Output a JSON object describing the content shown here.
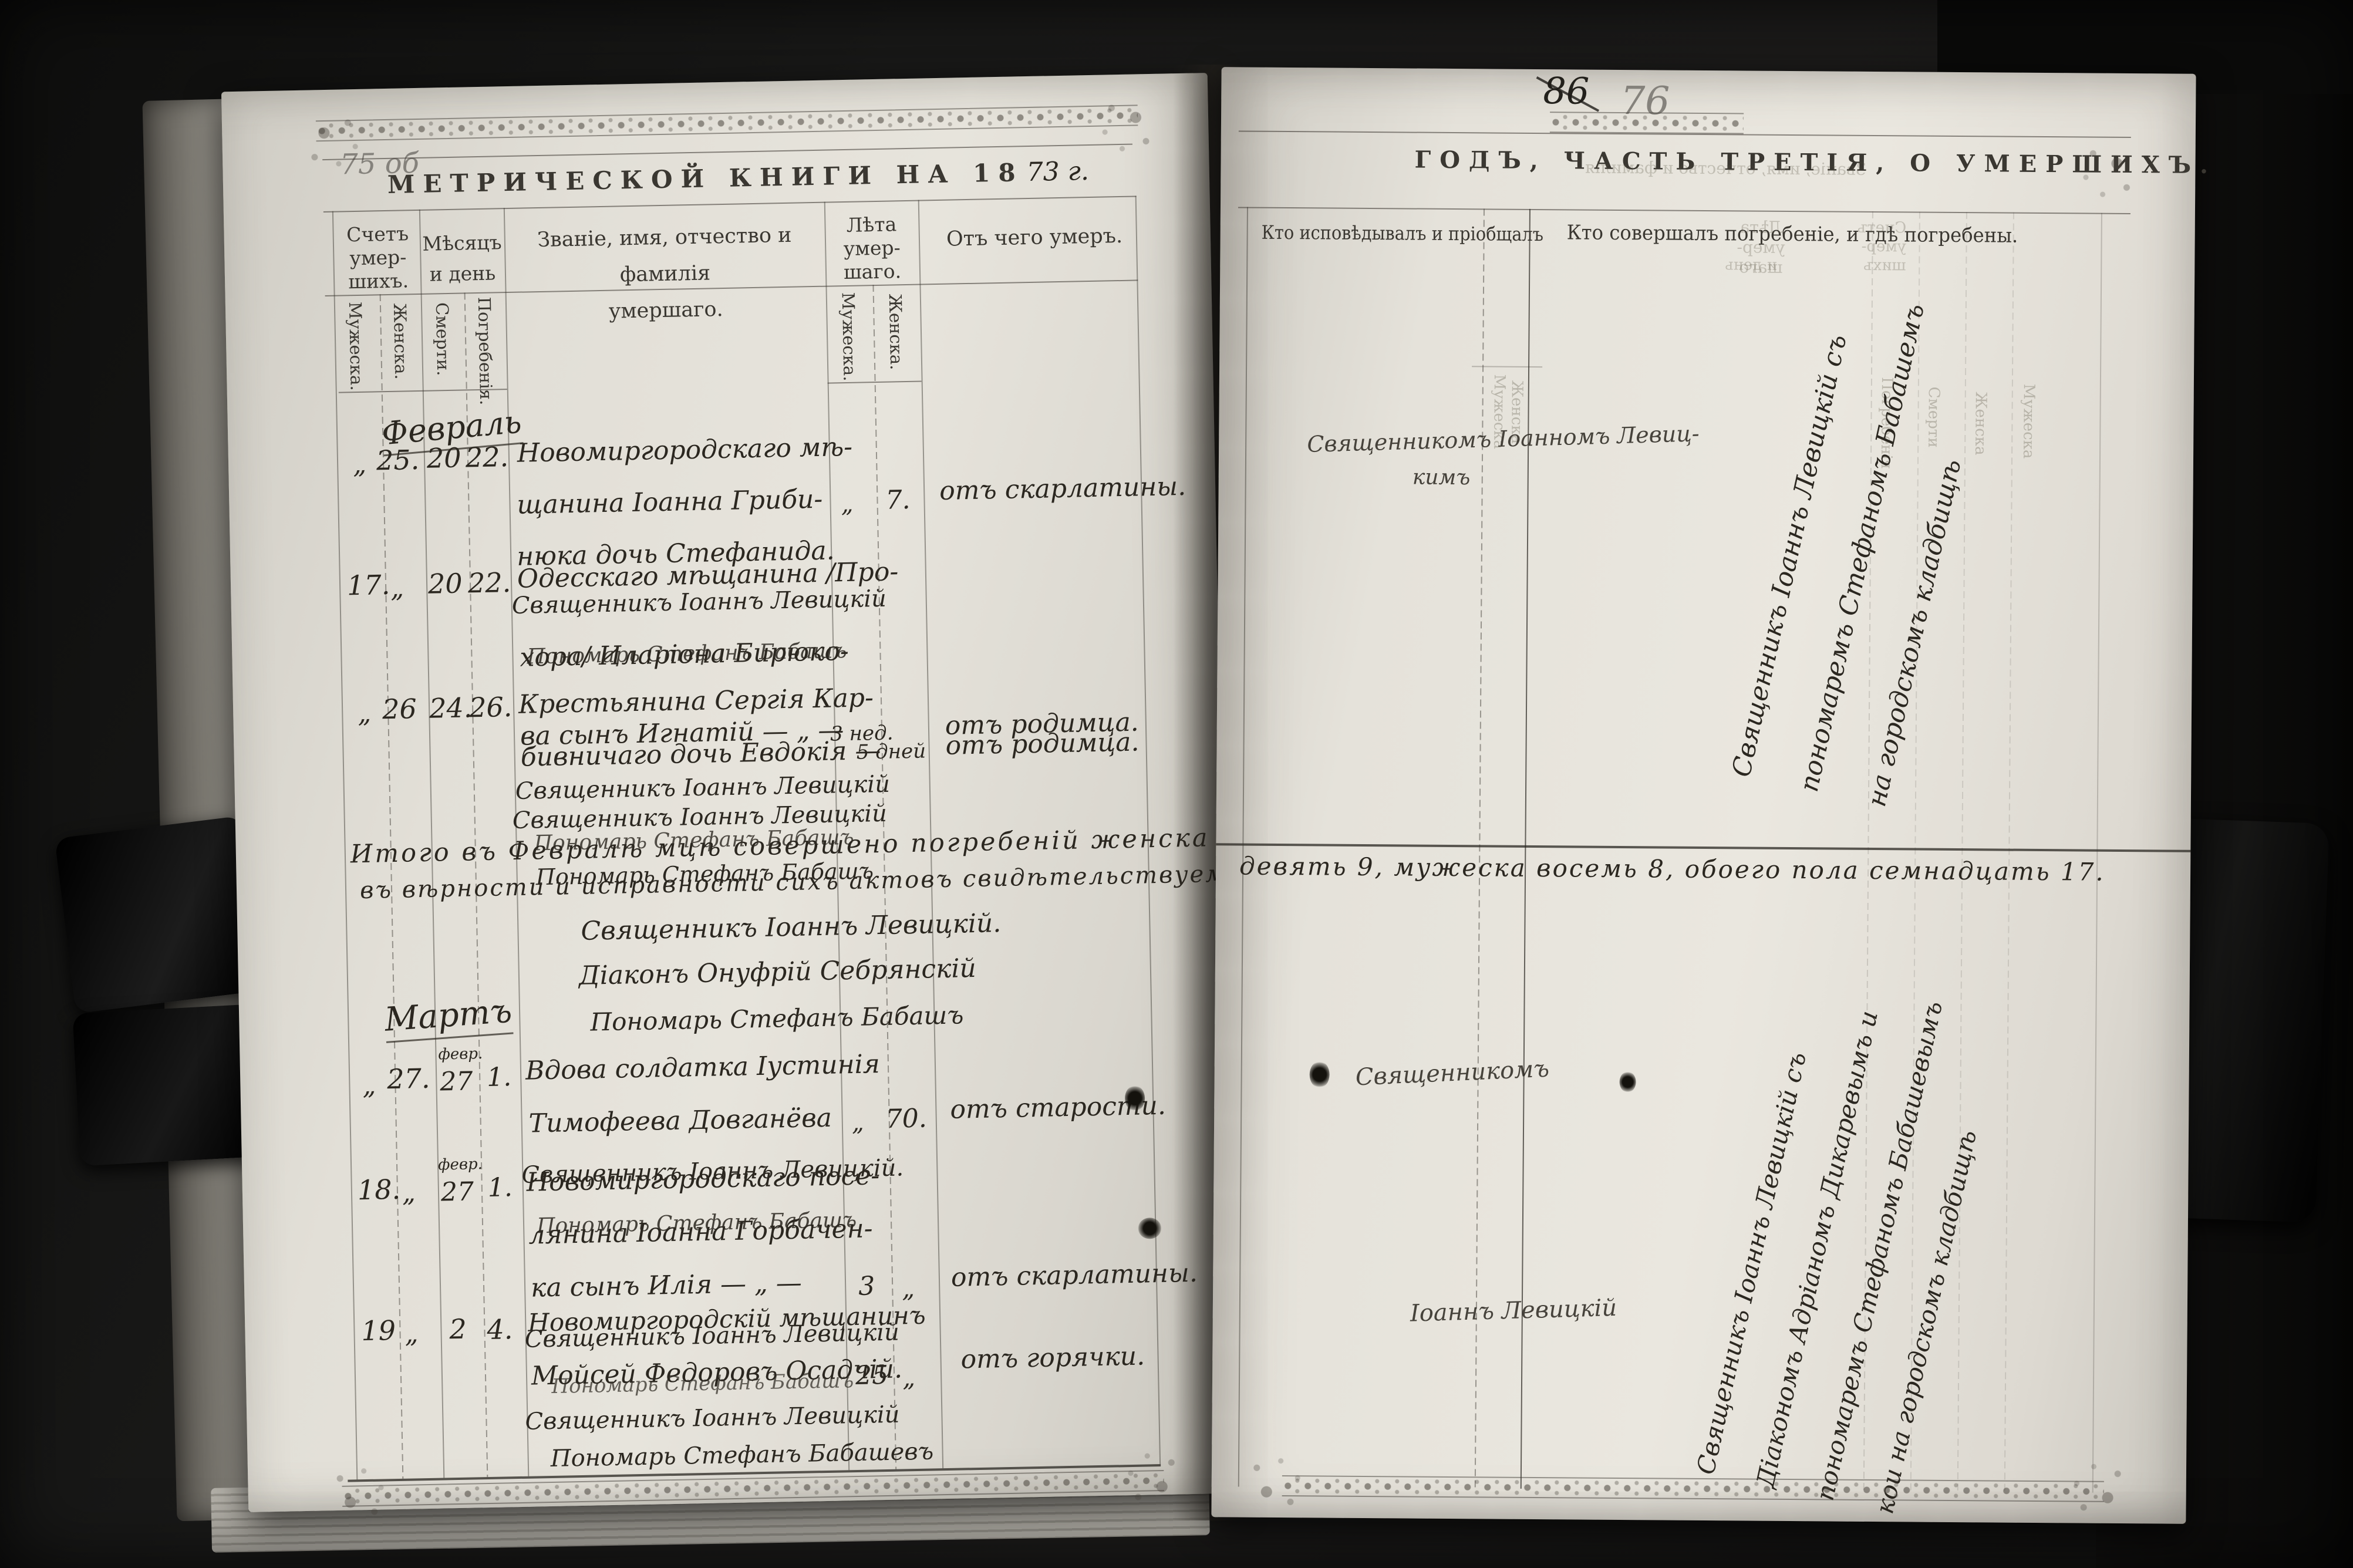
{
  "scene": {
    "background": "#141413",
    "page_color": "#e0ddd5",
    "ink": "#2b2720",
    "pencil": "#85827c",
    "objects": [
      "book-left-page",
      "book-right-page",
      "page-stack-left",
      "black-clip-left-upper",
      "black-clip-left-lower",
      "black-clamp-right",
      "book-cover-right"
    ]
  },
  "left_page": {
    "margin_note": "75 об",
    "title_printed": "МЕТРИЧЕСКОЙ КНИГИ НА 18",
    "title_year_hw": "73 г.",
    "header": {
      "count_label_1": "Счетъ",
      "count_label_2": "умер-",
      "count_label_3": "шихъ.",
      "count_male": "Мужеска.",
      "count_female": "Женска.",
      "month_label_1": "Мѣсяцъ",
      "month_label_2": "и день",
      "month_death": "Смерти.",
      "month_burial": "Погребенія.",
      "name_label_1": "Званіе, имя, отчество и фамилія",
      "name_label_2": "умершаго.",
      "age_label_1": "Лѣта",
      "age_label_2": "умер-",
      "age_label_3": "шаго.",
      "age_male": "Мужеска.",
      "age_female": "Женска.",
      "cause_label": "Отъ чего умеръ."
    },
    "february": {
      "month_label": "Февраль",
      "rows": [
        {
          "num_m": "„",
          "num_f": "25.",
          "d_death": "20",
          "d_burial": "22.",
          "lines": [
            "Новомиргородскаго мѣ-",
            "щанина Іоанна Гриби-",
            "нюка дочь Стефанида."
          ],
          "priest": "Священникъ Іоаннъ Левицкій",
          "sexton": "Пономарь Стефанъ Бабашъ",
          "age_m": "„",
          "age_f": "7.",
          "cause": "отъ скарлатины."
        },
        {
          "num_m": "17.",
          "num_f": "„",
          "d_death": "20",
          "d_burial": "22.",
          "lines": [
            "Одесскаго мѣщанина /Про-",
            "хора/ Иларіона Бирюко-",
            "ва сынъ Игнатій — „ —"
          ],
          "priest": "Священникъ Іоаннъ Левицкій",
          "sexton": "Пономарь Стефанъ Бабашъ",
          "age_m": "3 нед.",
          "age_f": "„",
          "cause": "отъ родимца."
        },
        {
          "num_m": "„",
          "num_f": "26",
          "d_death": "24.",
          "d_burial": "26.",
          "lines": [
            "Крестьянина Сергія Кар-",
            "бивничаго дочь Евдокія —"
          ],
          "priest": "Священникъ Іоаннъ Левицкій",
          "sexton": "Пономарь Стефанъ Бабашъ",
          "age_m": "„",
          "age_f": "5 дней",
          "cause": "отъ родимца."
        }
      ],
      "totals_line_1": "Итого въ Февралѣ мцѣ совершено погребеній женска",
      "totals_line_2": "въ вѣрности и исправности сихъ актовъ свидѣтельствуемъ:",
      "signature_priest": "Священникъ Іоаннъ Левицкій.",
      "signature_deacon": "Діаконъ Онуфрій Себрянскій",
      "signature_sexton": "Пономарь Стефанъ Бабашъ"
    },
    "march": {
      "month_label": "Мартъ",
      "rows": [
        {
          "num_m": "„",
          "num_f": "27.",
          "d_death_sup": "февр.",
          "d_death": "27",
          "d_burial": "1.",
          "lines": [
            "Вдова солдатка Іустинія",
            "Тимофеева Довганёва"
          ],
          "priest": "Священникъ Іоаннъ Левицкій.",
          "sexton": "Пономарь Стефанъ Бабашъ",
          "age_m": "„",
          "age_f": "70.",
          "cause": "отъ старости."
        },
        {
          "num_m": "18.",
          "num_f": "„",
          "d_death_sup": "февр.",
          "d_death": "27",
          "d_burial": "1.",
          "lines": [
            "Новомиргородскаго посе-",
            "лянина Іоанна Горбачен-",
            "ка сынъ Илія — „ —"
          ],
          "priest": "Священникъ Іоаннъ Левицкій",
          "sexton": "Пономарь Стефанъ Бабашъ",
          "age_m": "3",
          "age_f": "„",
          "cause": "отъ скарлатины."
        },
        {
          "num_m": "19",
          "num_f": "„",
          "d_death": "2",
          "d_burial": "4.",
          "lines": [
            "Новомиргородскій мѣщанинъ",
            "Мойсей Федоровъ Осадчій."
          ],
          "priest": "Священникъ Іоаннъ Левицкій",
          "sexton": "Пономарь Стефанъ Бабашевъ",
          "age_m": "25",
          "age_f": "„",
          "cause": "отъ горячки."
        }
      ]
    }
  },
  "right_page": {
    "folio_old": "86",
    "folio_new": "76",
    "title": "ГОДЪ, ЧАСТЬ ТРЕТІЯ, О УМЕРШИХЪ.",
    "header": {
      "confessed": "Кто исповѣдывалъ и пріобщалъ",
      "buried": "Кто совершалъ погребеніе, и гдѣ погребены."
    },
    "ghost": {
      "age_1": "Лѣта",
      "age_2": "умер-",
      "age_3": "шаго",
      "male": "Мужеска",
      "female": "Женска",
      "name": "Званіе, имя, отчество и фамилія",
      "month_1": "Мѣсяцъ",
      "month_2": "и день",
      "count_1": "Счетъ",
      "count_2": "умер-",
      "count_3": "шихъ",
      "burial_v": "Погребенія",
      "death_v": "Смерти"
    },
    "entries": {
      "feb_row1_line1": "Священникомъ Іоанномъ Левиц-",
      "feb_row1_line2": "кимъ",
      "feb_burial_diag": [
        "Священникъ Іоаннъ Левицкій съ",
        "пономаремъ Стефаномъ Бабашемъ",
        "на городскомъ кладбищѣ"
      ],
      "totals_continuation": "девять 9, мужеска восемь 8, обоего пола семнадцать 17.",
      "mar_row1": "Священникомъ",
      "mar_row3": "Іоаннъ Левицкій",
      "mar_burial_diag": [
        "Священникъ Іоаннъ Левицкій съ",
        "Діакономъ Адріаномъ Дикаревымъ и",
        "пономаремъ Стефаномъ Бабашевымъ",
        "кои на городскомъ кладбищѣ"
      ]
    }
  }
}
